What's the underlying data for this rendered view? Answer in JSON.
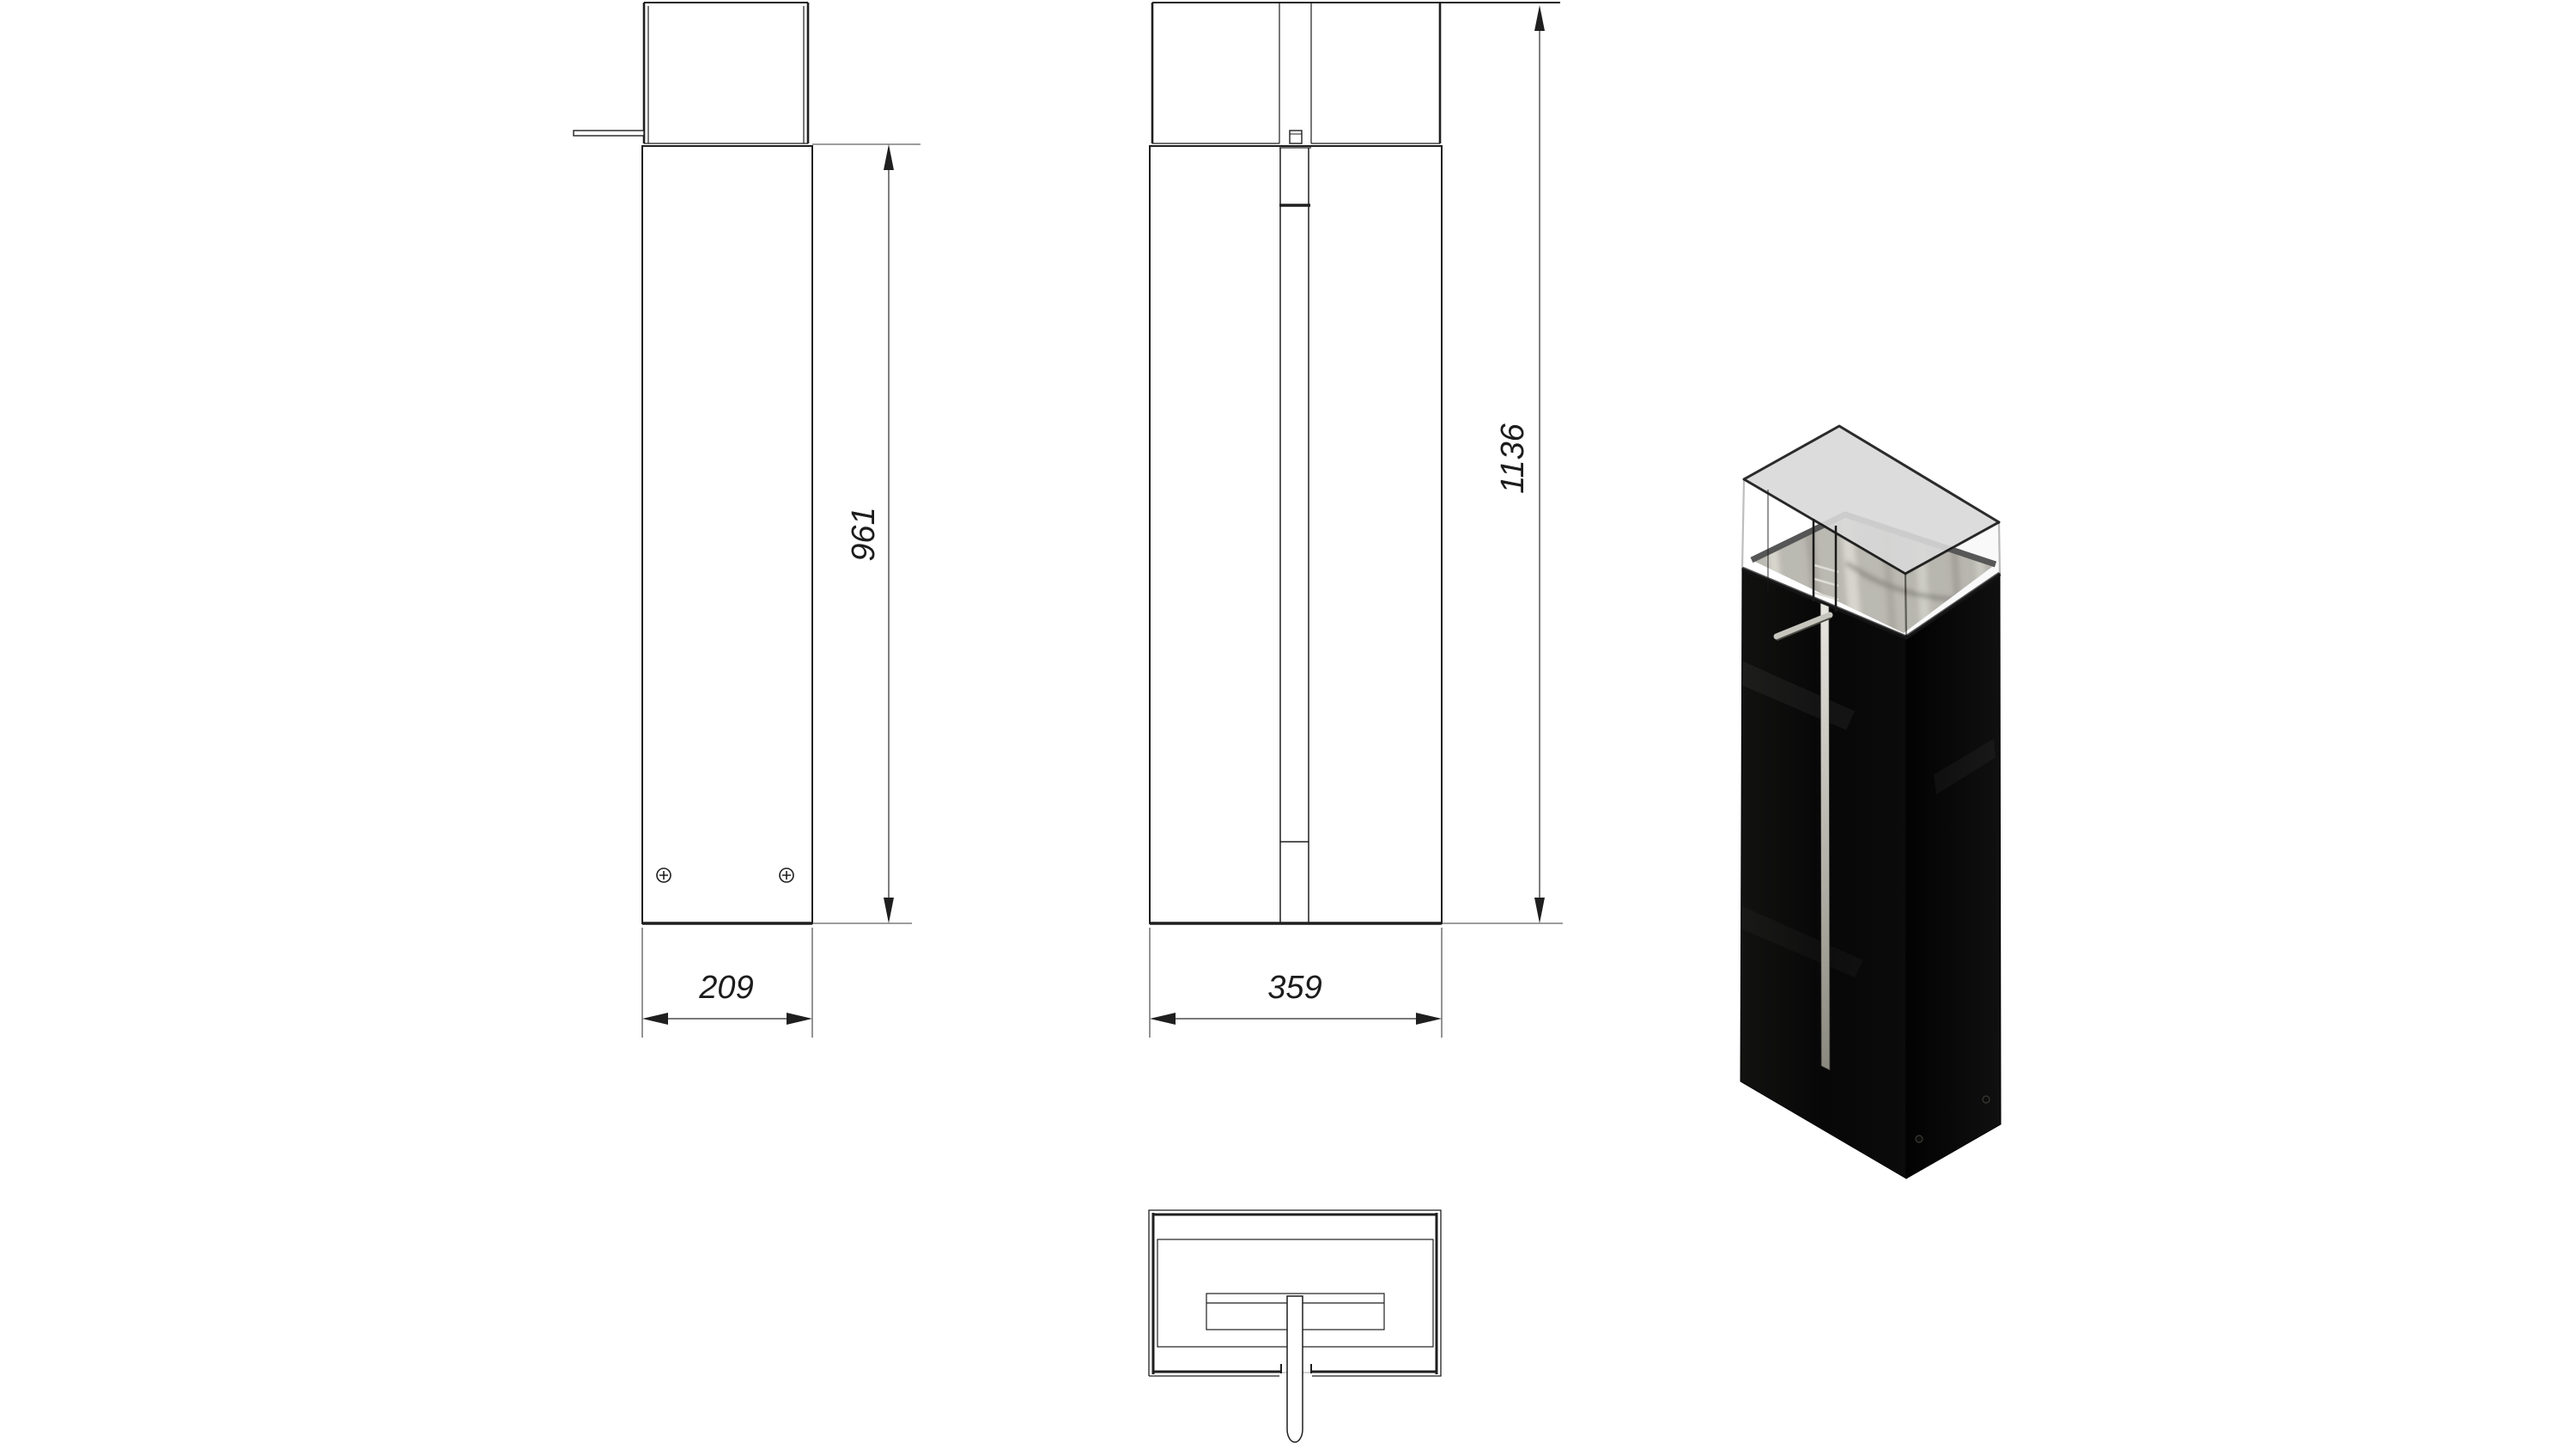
{
  "drawing": {
    "dimensions": {
      "side_body_height": "961",
      "side_width": "209",
      "front_total_height": "1136",
      "front_width": "359"
    },
    "colors": {
      "line": "#1f1f1f",
      "background": "#ffffff",
      "render_body": "#0a0a0a",
      "render_glass": "#d8d8d8",
      "render_burner": "#a09e94"
    }
  }
}
